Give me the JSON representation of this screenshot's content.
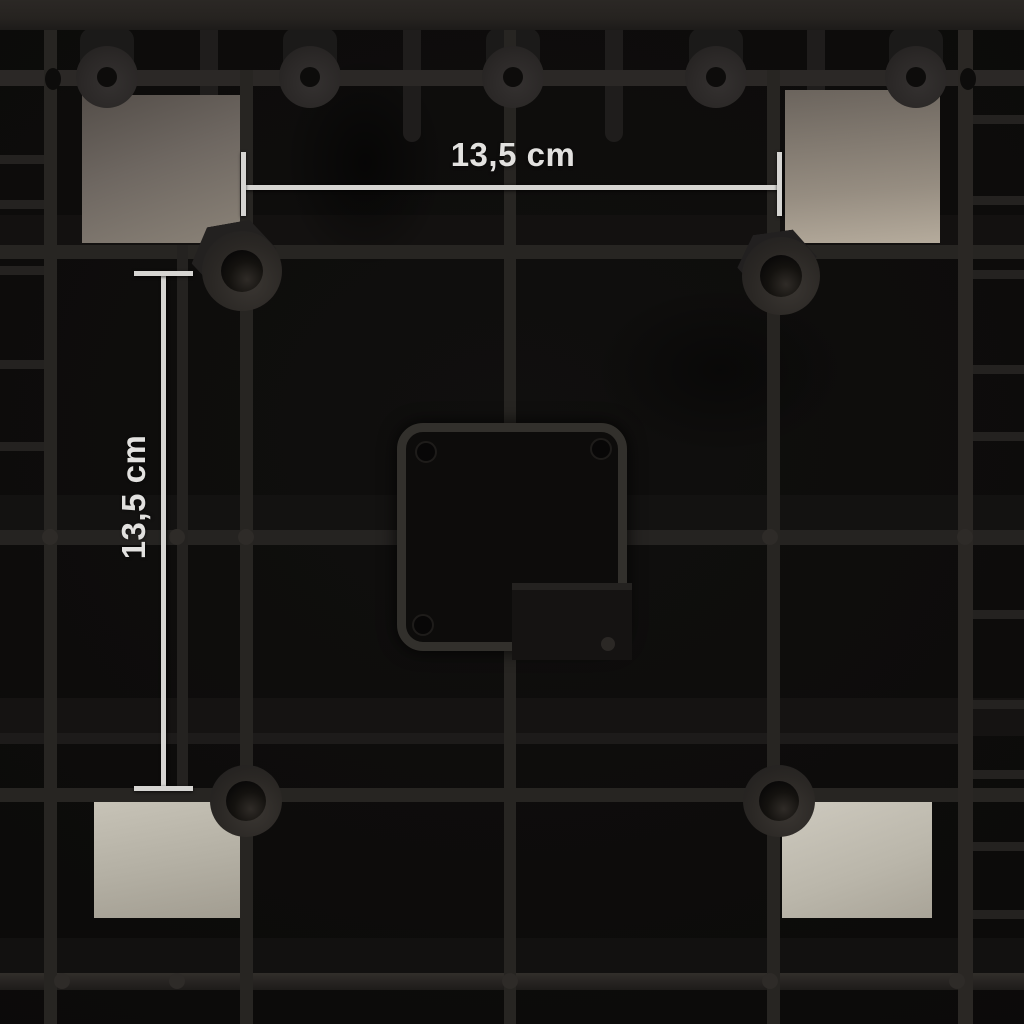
{
  "annotations": {
    "horizontal": {
      "label": "13,5 cm"
    },
    "vertical": {
      "label": "13,5 cm"
    }
  },
  "colors": {
    "background": "#0c0b0a",
    "plastic_rib": "#272522",
    "foam_light": "#c9c5b9",
    "foam_dark": "#6b645d",
    "dimension_line": "#d6d5d2",
    "label_text": "#e2e1df"
  },
  "photo": {
    "shapes": [
      {
        "name": "cell-shade-band",
        "x": 0,
        "y": 215,
        "w": 1024,
        "h": 30,
        "bg": "#131110"
      },
      {
        "name": "cell-shade-band",
        "x": 0,
        "y": 495,
        "w": 1024,
        "h": 35,
        "bg": "#131211"
      },
      {
        "name": "cell-shade-band",
        "x": 0,
        "y": 698,
        "w": 1024,
        "h": 38,
        "bg": "#151312"
      },
      {
        "name": "cell-shade-band",
        "x": 0,
        "y": 938,
        "w": 1024,
        "h": 37,
        "bg": "#121110"
      },
      {
        "name": "soft-shadow",
        "x": 285,
        "y": 55,
        "w": 160,
        "h": 215,
        "bg": "radial-gradient(closest-side, rgba(0,0,0,0.55) 0%, rgba(0,0,0,0) 100%)"
      },
      {
        "name": "soft-shadow",
        "x": 590,
        "y": 285,
        "w": 260,
        "h": 170,
        "bg": "radial-gradient(closest-side, rgba(0,0,0,0.4) 0%, rgba(0,0,0,0) 100%)"
      },
      {
        "name": "mold-pin",
        "x": 200,
        "y": 0,
        "w": 18,
        "h": 142,
        "bg": "#1f1d1c",
        "radius": "0 0 9px 9px"
      },
      {
        "name": "mold-pin",
        "x": 403,
        "y": 0,
        "w": 18,
        "h": 142,
        "bg": "#1f1d1c",
        "radius": "0 0 9px 9px"
      },
      {
        "name": "mold-pin",
        "x": 605,
        "y": 0,
        "w": 18,
        "h": 142,
        "bg": "#1f1d1c",
        "radius": "0 0 9px 9px"
      },
      {
        "name": "mold-pin",
        "x": 807,
        "y": 0,
        "w": 18,
        "h": 142,
        "bg": "#1f1d1c",
        "radius": "0 0 9px 9px"
      },
      {
        "name": "boss-nub",
        "x": 80,
        "y": 28,
        "w": 54,
        "h": 44,
        "bg": "#1b1a19",
        "radius": "12px"
      },
      {
        "name": "boss-nub",
        "x": 283,
        "y": 28,
        "w": 54,
        "h": 44,
        "bg": "#1b1a19",
        "radius": "12px"
      },
      {
        "name": "boss-nub",
        "x": 486,
        "y": 28,
        "w": 54,
        "h": 44,
        "bg": "#1b1a19",
        "radius": "12px"
      },
      {
        "name": "boss-nub",
        "x": 689,
        "y": 28,
        "w": 54,
        "h": 44,
        "bg": "#1b1a19",
        "radius": "12px"
      },
      {
        "name": "boss-nub",
        "x": 889,
        "y": 28,
        "w": 54,
        "h": 44,
        "bg": "#1b1a19",
        "radius": "12px"
      },
      {
        "name": "foam-pad-top-left",
        "x": 82,
        "y": 95,
        "w": 161,
        "h": 148,
        "bg": "linear-gradient(160deg, #544e49 0%, #6e6761 45%, #8b8378 100%)"
      },
      {
        "name": "foam-pad-top-right",
        "x": 785,
        "y": 90,
        "w": 155,
        "h": 153,
        "bg": "linear-gradient(175deg, #6b645d 0%, #968d81 65%, #b5ab9c 100%)"
      },
      {
        "name": "foam-pad-bottom-left",
        "x": 94,
        "y": 793,
        "w": 149,
        "h": 125,
        "bg": "linear-gradient(170deg, #c9c5b9 0%, #b4b0a4 55%, #a29d91 100%)"
      },
      {
        "name": "foam-pad-bottom-right",
        "x": 782,
        "y": 798,
        "w": 150,
        "h": 120,
        "bg": "linear-gradient(160deg, #cecabf 0%, #bab6aa 60%, #a9a498 100%)"
      },
      {
        "name": "grid-bar-top",
        "x": 0,
        "y": 0,
        "w": 1024,
        "h": 30,
        "bg": "linear-gradient(180deg, #2b2825 0%, #262320 60%, #1d1b19 100%)"
      },
      {
        "name": "grid-rib-horizontal",
        "x": 0,
        "y": 70,
        "w": 1024,
        "h": 16,
        "bg": "#2b2826"
      },
      {
        "name": "grid-rib-horizontal",
        "x": 0,
        "y": 245,
        "w": 1024,
        "h": 14,
        "bg": "#272522"
      },
      {
        "name": "grid-rib-horizontal",
        "x": 0,
        "y": 530,
        "w": 1024,
        "h": 15,
        "bg": "#252321"
      },
      {
        "name": "grid-rib-horizontal",
        "x": 0,
        "y": 733,
        "w": 965,
        "h": 11,
        "bg": "#1d1b1a"
      },
      {
        "name": "grid-rib-horizontal",
        "x": 0,
        "y": 788,
        "w": 1024,
        "h": 14,
        "bg": "#272522"
      },
      {
        "name": "grid-bar-bottom",
        "x": 0,
        "y": 973,
        "w": 1024,
        "h": 17,
        "bg": "linear-gradient(180deg, #322f2b 0%, #262321 55%, #1e1c1a 100%)"
      },
      {
        "name": "grid-rib-horizontal",
        "x": 0,
        "y": 155,
        "w": 44,
        "h": 9,
        "bg": "#242220"
      },
      {
        "name": "grid-rib-horizontal",
        "x": 0,
        "y": 200,
        "w": 44,
        "h": 9,
        "bg": "#242220"
      },
      {
        "name": "grid-rib-horizontal",
        "x": 0,
        "y": 266,
        "w": 44,
        "h": 9,
        "bg": "#242220"
      },
      {
        "name": "grid-rib-horizontal",
        "x": 0,
        "y": 360,
        "w": 44,
        "h": 9,
        "bg": "#242220"
      },
      {
        "name": "grid-rib-horizontal",
        "x": 0,
        "y": 442,
        "w": 44,
        "h": 9,
        "bg": "#242220"
      },
      {
        "name": "grid-rib-horizontal",
        "x": 973,
        "y": 115,
        "w": 51,
        "h": 9,
        "bg": "#242220"
      },
      {
        "name": "grid-rib-horizontal",
        "x": 973,
        "y": 196,
        "w": 51,
        "h": 9,
        "bg": "#242220"
      },
      {
        "name": "grid-rib-horizontal",
        "x": 973,
        "y": 270,
        "w": 51,
        "h": 9,
        "bg": "#242220"
      },
      {
        "name": "grid-rib-horizontal",
        "x": 973,
        "y": 365,
        "w": 51,
        "h": 9,
        "bg": "#242220"
      },
      {
        "name": "grid-rib-horizontal",
        "x": 973,
        "y": 432,
        "w": 51,
        "h": 9,
        "bg": "#242220"
      },
      {
        "name": "grid-rib-horizontal",
        "x": 973,
        "y": 610,
        "w": 51,
        "h": 9,
        "bg": "#242220"
      },
      {
        "name": "grid-rib-horizontal",
        "x": 973,
        "y": 700,
        "w": 51,
        "h": 9,
        "bg": "#242220"
      },
      {
        "name": "grid-rib-horizontal",
        "x": 973,
        "y": 770,
        "w": 51,
        "h": 9,
        "bg": "#242220"
      },
      {
        "name": "grid-rib-horizontal",
        "x": 973,
        "y": 842,
        "w": 51,
        "h": 9,
        "bg": "#242220"
      },
      {
        "name": "grid-rib-horizontal",
        "x": 973,
        "y": 910,
        "w": 51,
        "h": 9,
        "bg": "#242220"
      },
      {
        "name": "grid-rib-vertical",
        "x": 44,
        "y": 30,
        "w": 13,
        "h": 994,
        "bg": "#272522"
      },
      {
        "name": "grid-rib-vertical",
        "x": 177,
        "y": 245,
        "w": 11,
        "h": 543,
        "bg": "#242220"
      },
      {
        "name": "grid-rib-vertical",
        "x": 240,
        "y": 70,
        "w": 13,
        "h": 954,
        "bg": "#272522"
      },
      {
        "name": "grid-rib-vertical",
        "x": 504,
        "y": 30,
        "w": 12,
        "h": 393,
        "bg": "#272522"
      },
      {
        "name": "grid-rib-vertical",
        "x": 504,
        "y": 650,
        "w": 12,
        "h": 374,
        "bg": "#272522"
      },
      {
        "name": "grid-rib-vertical",
        "x": 767,
        "y": 70,
        "w": 13,
        "h": 954,
        "bg": "#272522"
      },
      {
        "name": "grid-rib-vertical",
        "x": 958,
        "y": 30,
        "w": 15,
        "h": 994,
        "bg": "#2a2724"
      },
      {
        "name": "screw-boss",
        "x": 76,
        "y": 46,
        "w": 62,
        "h": 62,
        "bg": "radial-gradient(circle at 55% 60%, #343130 0%, #2b2827 55%, #211f1e 100%)",
        "radius": "50%"
      },
      {
        "name": "screw-boss",
        "x": 279,
        "y": 46,
        "w": 62,
        "h": 62,
        "bg": "radial-gradient(circle at 55% 60%, #343130 0%, #2b2827 55%, #211f1e 100%)",
        "radius": "50%"
      },
      {
        "name": "screw-boss",
        "x": 482,
        "y": 46,
        "w": 62,
        "h": 62,
        "bg": "radial-gradient(circle at 55% 60%, #343130 0%, #2b2827 55%, #211f1e 100%)",
        "radius": "50%"
      },
      {
        "name": "screw-boss",
        "x": 685,
        "y": 46,
        "w": 62,
        "h": 62,
        "bg": "radial-gradient(circle at 55% 60%, #343130 0%, #2b2827 55%, #211f1e 100%)",
        "radius": "50%"
      },
      {
        "name": "screw-boss",
        "x": 885,
        "y": 46,
        "w": 62,
        "h": 62,
        "bg": "radial-gradient(circle at 55% 60%, #343130 0%, #2b2827 55%, #211f1e 100%)",
        "radius": "50%"
      },
      {
        "name": "screw-boss-hole",
        "x": 97,
        "y": 67,
        "w": 20,
        "h": 20,
        "bg": "#0d0c0b",
        "radius": "50%"
      },
      {
        "name": "screw-boss-hole",
        "x": 300,
        "y": 67,
        "w": 20,
        "h": 20,
        "bg": "#0d0c0b",
        "radius": "50%"
      },
      {
        "name": "screw-boss-hole",
        "x": 503,
        "y": 67,
        "w": 20,
        "h": 20,
        "bg": "#0d0c0b",
        "radius": "50%"
      },
      {
        "name": "screw-boss-hole",
        "x": 706,
        "y": 67,
        "w": 20,
        "h": 20,
        "bg": "#0d0c0b",
        "radius": "50%"
      },
      {
        "name": "screw-boss-hole",
        "x": 906,
        "y": 67,
        "w": 20,
        "h": 20,
        "bg": "#0d0c0b",
        "radius": "50%"
      },
      {
        "name": "vent-hole",
        "x": 45,
        "y": 68,
        "w": 16,
        "h": 22,
        "bg": "#0d0c0b",
        "radius": "50%"
      },
      {
        "name": "vent-hole",
        "x": 960,
        "y": 68,
        "w": 16,
        "h": 22,
        "bg": "#0d0c0b",
        "radius": "50%"
      },
      {
        "name": "cup-flange",
        "x": 191,
        "y": 223,
        "w": 86,
        "h": 66,
        "bg": "#232120",
        "clip": "polygon(25% 0%, 75% 0%, 100% 50%, 75% 100%, 25% 100%, 0% 50%)",
        "transform": "rotate(-10deg)"
      },
      {
        "name": "cup-flange",
        "x": 737,
        "y": 232,
        "w": 80,
        "h": 60,
        "bg": "#222020",
        "clip": "polygon(25% 0%, 75% 0%, 100% 50%, 75% 100%, 25% 100%, 0% 50%)",
        "transform": "rotate(-8deg)"
      },
      {
        "name": "support-cup",
        "x": 202,
        "y": 231,
        "w": 80,
        "h": 80,
        "bg": "radial-gradient(circle at 60% 65%, #3a3632 0%, #2a2724 55%, #232120 85%)",
        "radius": "50%"
      },
      {
        "name": "support-cup",
        "x": 742,
        "y": 237,
        "w": 78,
        "h": 78,
        "bg": "radial-gradient(circle at 60% 65%, #3a3632 0%, #2a2724 55%, #232120 85%)",
        "radius": "50%"
      },
      {
        "name": "support-cup",
        "x": 210,
        "y": 765,
        "w": 72,
        "h": 72,
        "bg": "radial-gradient(circle at 60% 65%, #3a3632 0%, #2a2724 55%, #232120 85%)",
        "radius": "50%"
      },
      {
        "name": "support-cup",
        "x": 743,
        "y": 765,
        "w": 72,
        "h": 72,
        "bg": "radial-gradient(circle at 60% 65%, #3a3632 0%, #2a2724 55%, #232120 85%)",
        "radius": "50%"
      },
      {
        "name": "support-cup-hole",
        "x": 221,
        "y": 250,
        "w": 42,
        "h": 42,
        "bg": "radial-gradient(circle at 62% 70%, #2f2b27 0%, #14120f 45%, #090808 78%)",
        "radius": "50%"
      },
      {
        "name": "support-cup-hole",
        "x": 760,
        "y": 255,
        "w": 42,
        "h": 42,
        "bg": "radial-gradient(circle at 62% 70%, #2f2b27 0%, #14120f 45%, #090808 78%)",
        "radius": "50%"
      },
      {
        "name": "support-cup-hole",
        "x": 226,
        "y": 781,
        "w": 40,
        "h": 40,
        "bg": "radial-gradient(circle at 62% 70%, #2f2b27 0%, #14120f 45%, #090808 78%)",
        "radius": "50%"
      },
      {
        "name": "support-cup-hole",
        "x": 759,
        "y": 781,
        "w": 40,
        "h": 40,
        "bg": "radial-gradient(circle at 62% 70%, #2f2b27 0%, #14120f 45%, #090808 78%)",
        "radius": "50%"
      },
      {
        "name": "center-socket-frame",
        "x": 397,
        "y": 423,
        "w": 212,
        "h": 210,
        "bg": "#0d0c0b",
        "border": "9px solid #32302c",
        "radius": "26px",
        "shadow": "0 0 18px rgba(0,0,0,0.8)"
      },
      {
        "name": "socket-corner-hole",
        "x": 415,
        "y": 441,
        "w": 18,
        "h": 18,
        "bg": "#080707",
        "border": "2px solid #1e1c1a",
        "radius": "50%"
      },
      {
        "name": "socket-corner-hole",
        "x": 590,
        "y": 438,
        "w": 18,
        "h": 18,
        "bg": "#080707",
        "border": "2px solid #1e1c1a",
        "radius": "50%"
      },
      {
        "name": "socket-corner-hole",
        "x": 412,
        "y": 614,
        "w": 18,
        "h": 18,
        "bg": "#080707",
        "border": "2px solid #1e1c1a",
        "radius": "50%"
      },
      {
        "name": "socket-corner-hole",
        "x": 591,
        "y": 615,
        "w": 18,
        "h": 18,
        "bg": "#080707",
        "border": "2px solid #1e1c1a",
        "radius": "50%"
      },
      {
        "name": "mold-step",
        "x": 512,
        "y": 583,
        "w": 120,
        "h": 7,
        "bg": "#242220"
      },
      {
        "name": "mold-step",
        "x": 512,
        "y": 590,
        "w": 120,
        "h": 70,
        "bg": "#151312"
      },
      {
        "name": "rib-bump",
        "x": 601,
        "y": 637,
        "w": 14,
        "h": 14,
        "bg": "#2b2825",
        "radius": "50%"
      },
      {
        "name": "rib-bump",
        "x": 42,
        "y": 529,
        "w": 16,
        "h": 16,
        "bg": "#2e2b28",
        "radius": "50%"
      },
      {
        "name": "rib-bump",
        "x": 169,
        "y": 529,
        "w": 16,
        "h": 16,
        "bg": "#2e2b28",
        "radius": "50%"
      },
      {
        "name": "rib-bump",
        "x": 238,
        "y": 529,
        "w": 16,
        "h": 16,
        "bg": "#2e2b28",
        "radius": "50%"
      },
      {
        "name": "rib-bump",
        "x": 762,
        "y": 529,
        "w": 16,
        "h": 16,
        "bg": "#2e2b28",
        "radius": "50%"
      },
      {
        "name": "rib-bump",
        "x": 957,
        "y": 529,
        "w": 16,
        "h": 16,
        "bg": "#2e2b28",
        "radius": "50%"
      },
      {
        "name": "rib-bump",
        "x": 54,
        "y": 973,
        "w": 16,
        "h": 16,
        "bg": "#2e2b28",
        "radius": "50%"
      },
      {
        "name": "rib-bump",
        "x": 169,
        "y": 973,
        "w": 16,
        "h": 16,
        "bg": "#2e2b28",
        "radius": "50%"
      },
      {
        "name": "rib-bump",
        "x": 502,
        "y": 973,
        "w": 16,
        "h": 16,
        "bg": "#2e2b28",
        "radius": "50%"
      },
      {
        "name": "rib-bump",
        "x": 762,
        "y": 973,
        "w": 16,
        "h": 16,
        "bg": "#2e2b28",
        "radius": "50%"
      },
      {
        "name": "rib-bump",
        "x": 949,
        "y": 973,
        "w": 16,
        "h": 16,
        "bg": "#2e2b28",
        "radius": "50%"
      },
      {
        "name": "dimension-line-horizontal",
        "x": 243,
        "y": 185,
        "w": 537,
        "h": 5,
        "bg": "#d6d5d2",
        "shadow": "0 1px 3px rgba(0,0,0,0.7)"
      },
      {
        "name": "dimension-tick",
        "x": 241,
        "y": 152,
        "w": 5,
        "h": 64,
        "bg": "#d6d5d2",
        "shadow": "0 1px 3px rgba(0,0,0,0.7)"
      },
      {
        "name": "dimension-tick",
        "x": 777,
        "y": 152,
        "w": 5,
        "h": 64,
        "bg": "#d6d5d2",
        "shadow": "0 1px 3px rgba(0,0,0,0.7)"
      },
      {
        "name": "dimension-line-vertical",
        "x": 161,
        "y": 273,
        "w": 5,
        "h": 516,
        "bg": "#d6d5d2",
        "shadow": "1px 0 3px rgba(0,0,0,0.7)"
      },
      {
        "name": "dimension-tick",
        "x": 134,
        "y": 271,
        "w": 59,
        "h": 5,
        "bg": "#d6d5d2",
        "shadow": "0 1px 3px rgba(0,0,0,0.7)"
      },
      {
        "name": "dimension-tick",
        "x": 134,
        "y": 786,
        "w": 59,
        "h": 5,
        "bg": "#d6d5d2",
        "shadow": "0 1px 3px rgba(0,0,0,0.7)"
      }
    ]
  }
}
